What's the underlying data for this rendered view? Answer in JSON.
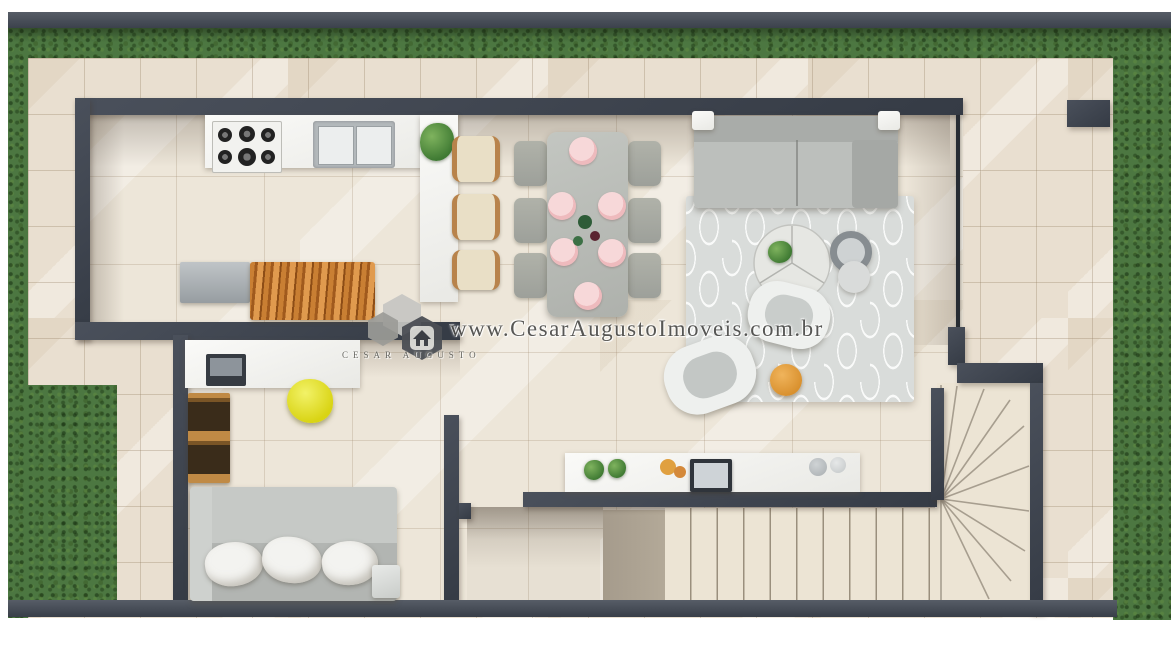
{
  "meta": {
    "type": "floor-plan-3d-render",
    "view": "top-down"
  },
  "watermark": {
    "url_text": "www.CesarAugustoImoveis.com.br",
    "brand_text": "CESAR AUGUSTO",
    "logo_icon": "house-hexagon-icon"
  },
  "palette": {
    "wall": "#3d434e",
    "interior_floor": "#ede6d9",
    "exterior_paving": "#e9dfd0",
    "grass": "#4c7741",
    "sofa_gray": "#b6b9b6",
    "rug_gray": "#d9dcda",
    "wood_counter": "#b06a28",
    "stool_cream": "#e9dfc6",
    "chair_yellow": "#e4e532",
    "pouf_orange": "#e09b3d",
    "plate_pink": "#f2c6c8",
    "plant_green": "#4c8040"
  },
  "inventory": {
    "kitchen": [
      "gas-cooktop",
      "double-sink",
      "island-counter",
      "bar-stools-x3",
      "refrigerator",
      "wood-prep-counter",
      "counter-plant"
    ],
    "dining": {
      "table": "rectangular",
      "chairs": 6,
      "place_settings": 6
    },
    "living": [
      "sofa-with-chaise",
      "patterned-rug",
      "round-coffee-table",
      "nesting-side-tables-x2",
      "armchairs-x2",
      "orange-pouf"
    ],
    "office": [
      "desk",
      "monitor",
      "yellow-chair",
      "wood-bookshelf"
    ],
    "tv_lounge": [
      "sofa-with-cushions-x3",
      "media-sideboard",
      "tv-panel",
      "decor-vases-x2"
    ],
    "stairs": {
      "straight_treads": 10,
      "winder_treads": 9,
      "turn": "quarter"
    }
  }
}
